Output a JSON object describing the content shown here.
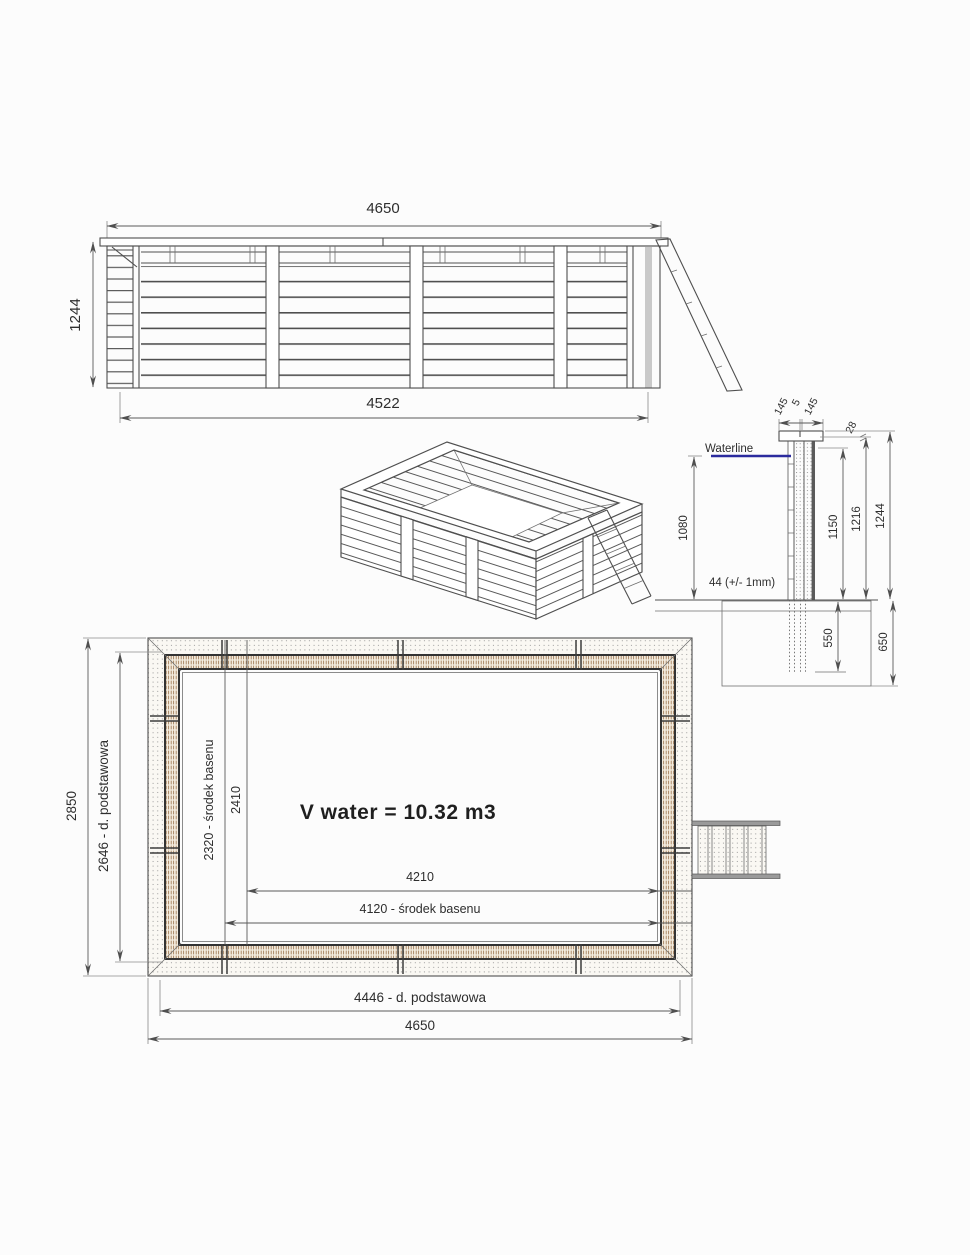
{
  "page": {
    "bg": "#fcfcfc"
  },
  "colors": {
    "line": "#4f4f4f",
    "waterline": "#2b2b9e"
  },
  "elevation": {
    "dim_width_top": "4650",
    "dim_width_bottom": "4522",
    "dim_height": "1244"
  },
  "section": {
    "dim_cap_left": "145",
    "dim_cap_gap": "5",
    "dim_cap_right": "145",
    "dim_cap_thickness": "28",
    "waterline_label": "Waterline",
    "dim_water_depth": "1080",
    "dim_waterline_height": "1150",
    "dim_wall_inner_height": "1216",
    "dim_total_height": "1244",
    "plank_thickness_note": "44 (+/- 1mm)",
    "dim_post_embed": "550",
    "dim_foundation_depth": "650"
  },
  "plan": {
    "volume_label": "V water = 10.32 m3",
    "dim_outer_width": "2850",
    "dim_base_width": "2646 - d. podstawowa",
    "dim_center_width": "2320 - środek basenu",
    "dim_inner_width": "2410",
    "dim_inner_length": "4210",
    "dim_center_length": "4120 - środek basenu",
    "dim_base_length": "4446 - d. podstawowa",
    "dim_outer_length": "4650"
  }
}
